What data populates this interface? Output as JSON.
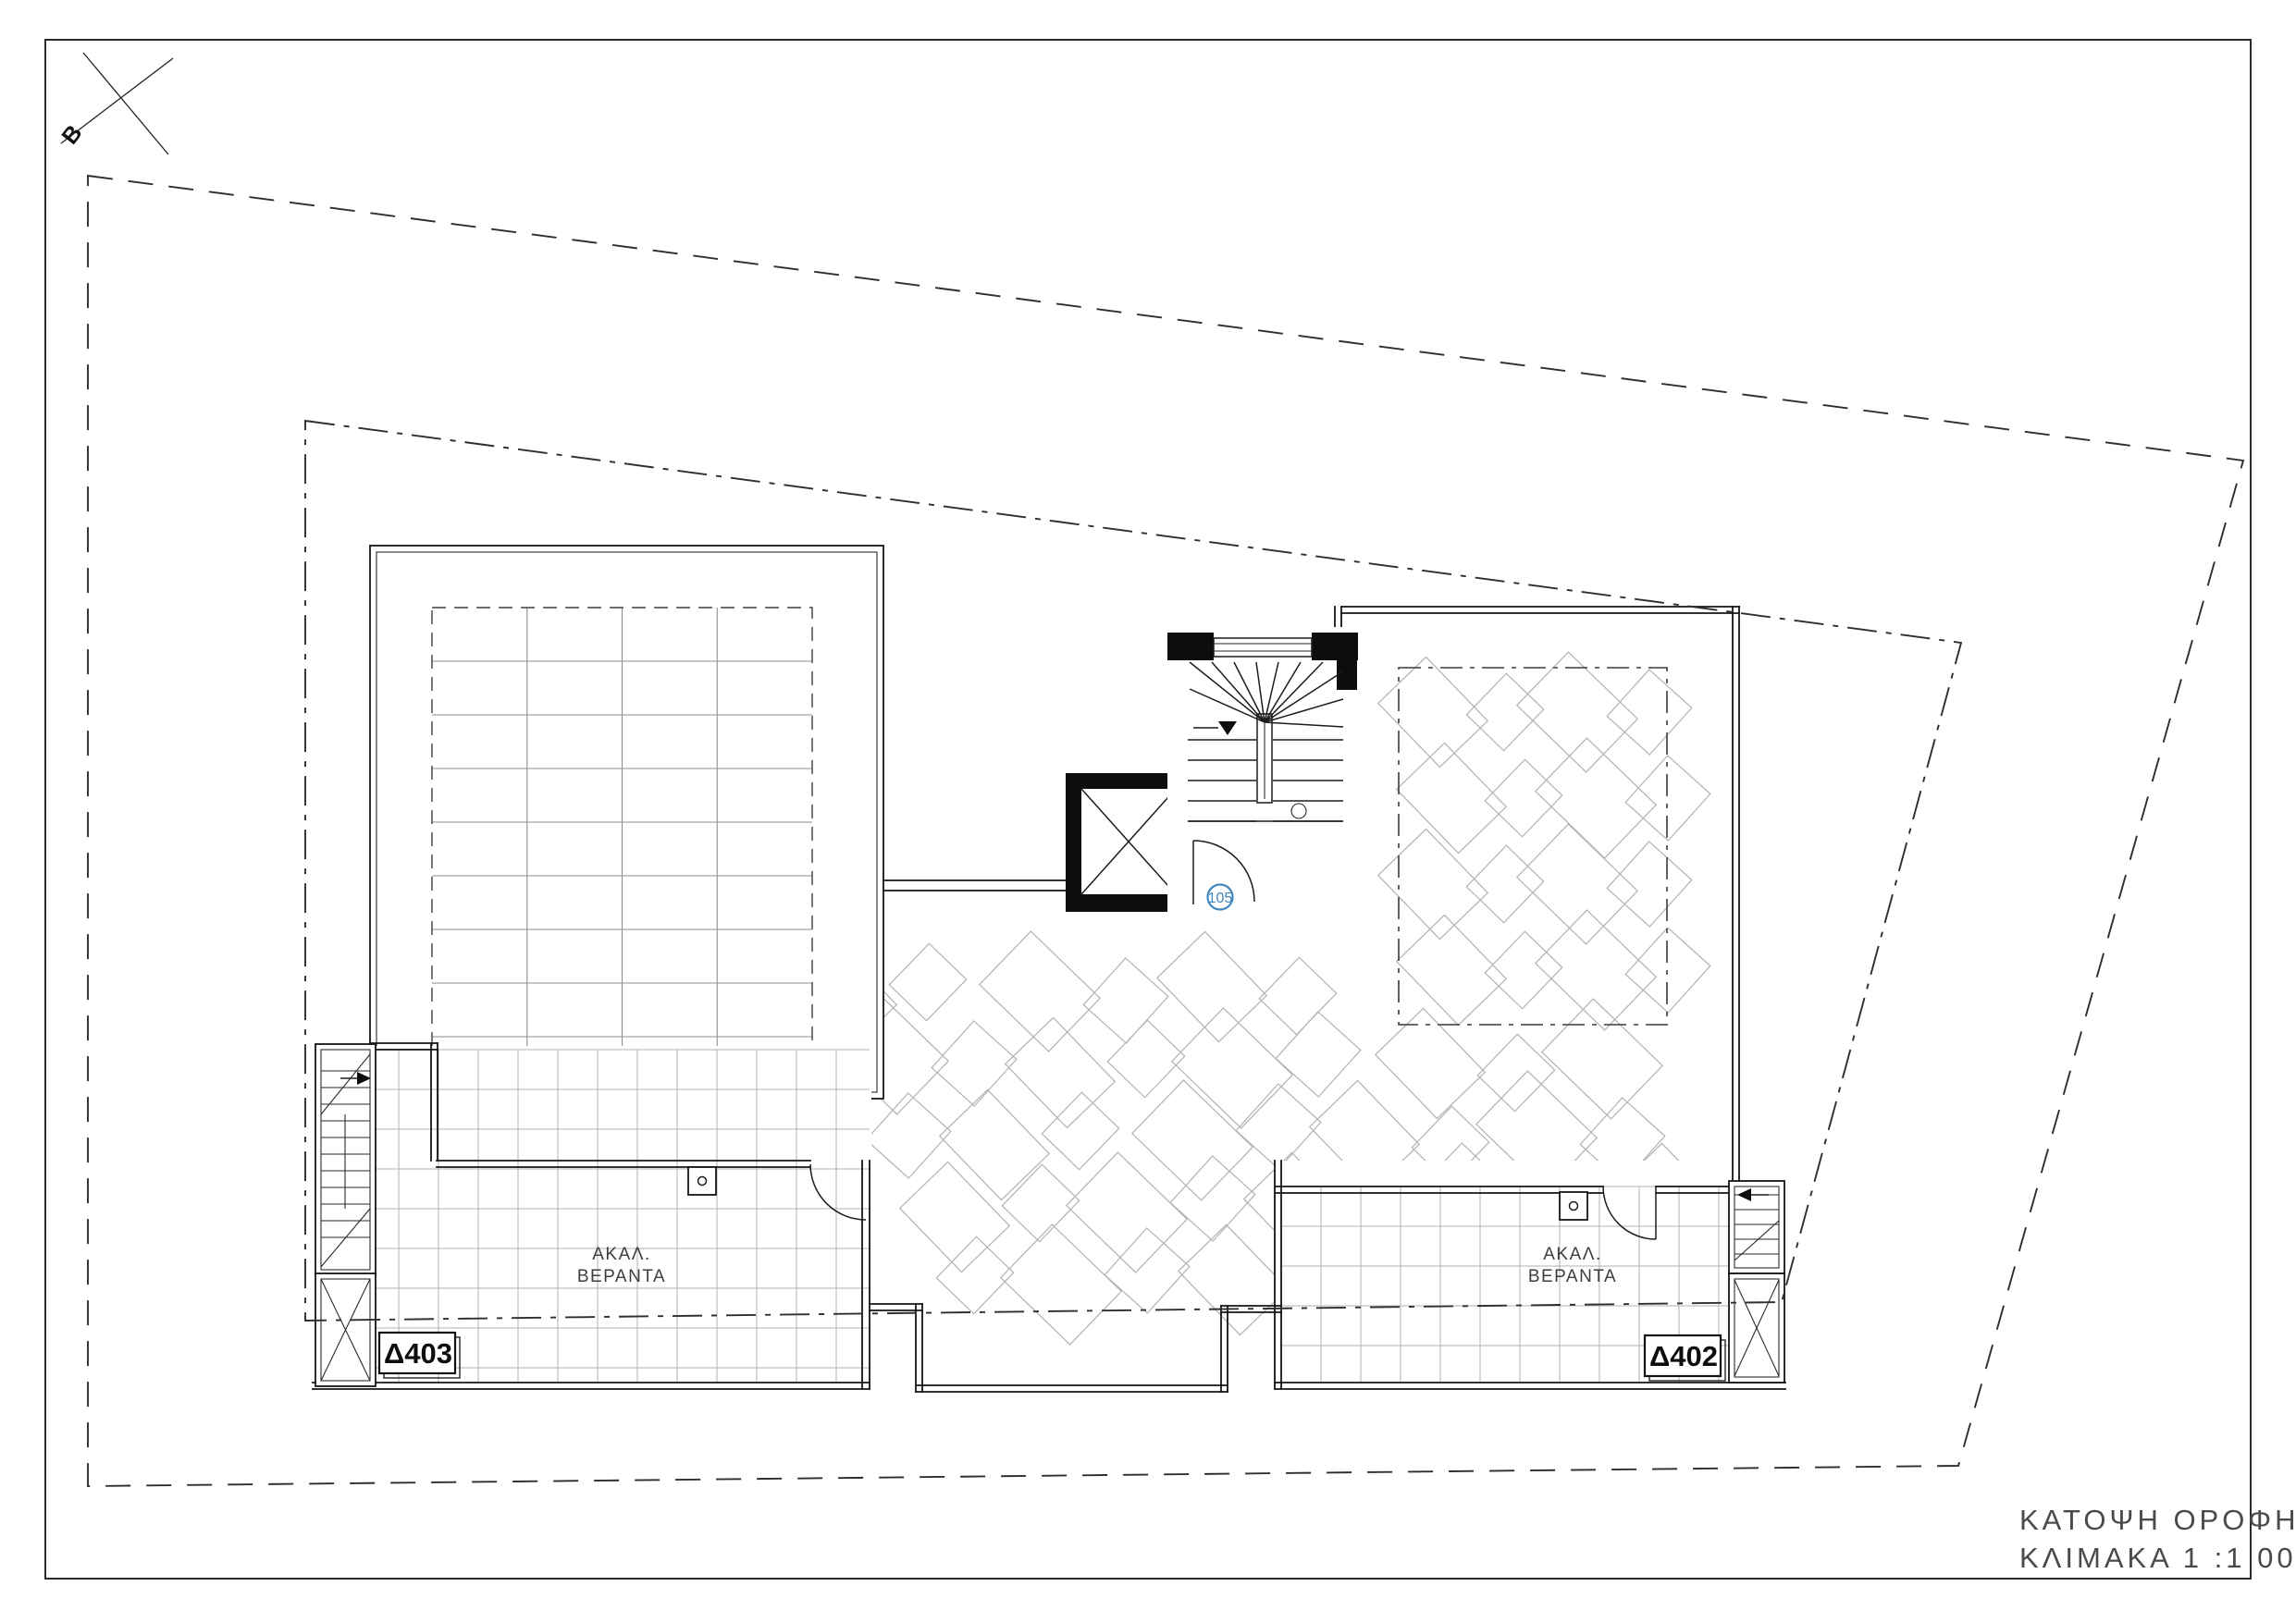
{
  "sheet": {
    "title_line1": "ΚΑΤΟΨΗ  ΟΡΟΦΗΣ",
    "title_line2": "ΚΛΙΜΑΚΑ 1 :1 00",
    "marker_label": "B"
  },
  "units": [
    {
      "id": "Δ403",
      "veranda_line1": "ΑΚΑΛ.",
      "veranda_line2": "ΒΕΡΑΝΤΑ"
    },
    {
      "id": "Δ402",
      "veranda_line1": "ΑΚΑΛ.",
      "veranda_line2": "ΒΕΡΑΝΤΑ"
    }
  ],
  "stair_room_number": "105",
  "colors": {
    "accent_blue": "#4288bf",
    "wall_line": "#141414",
    "boundary_line": "#2e2e2e",
    "tile_line": "#b1b1b1",
    "paver_line": "#b6b6b6",
    "title_text": "#4a4a4a"
  }
}
